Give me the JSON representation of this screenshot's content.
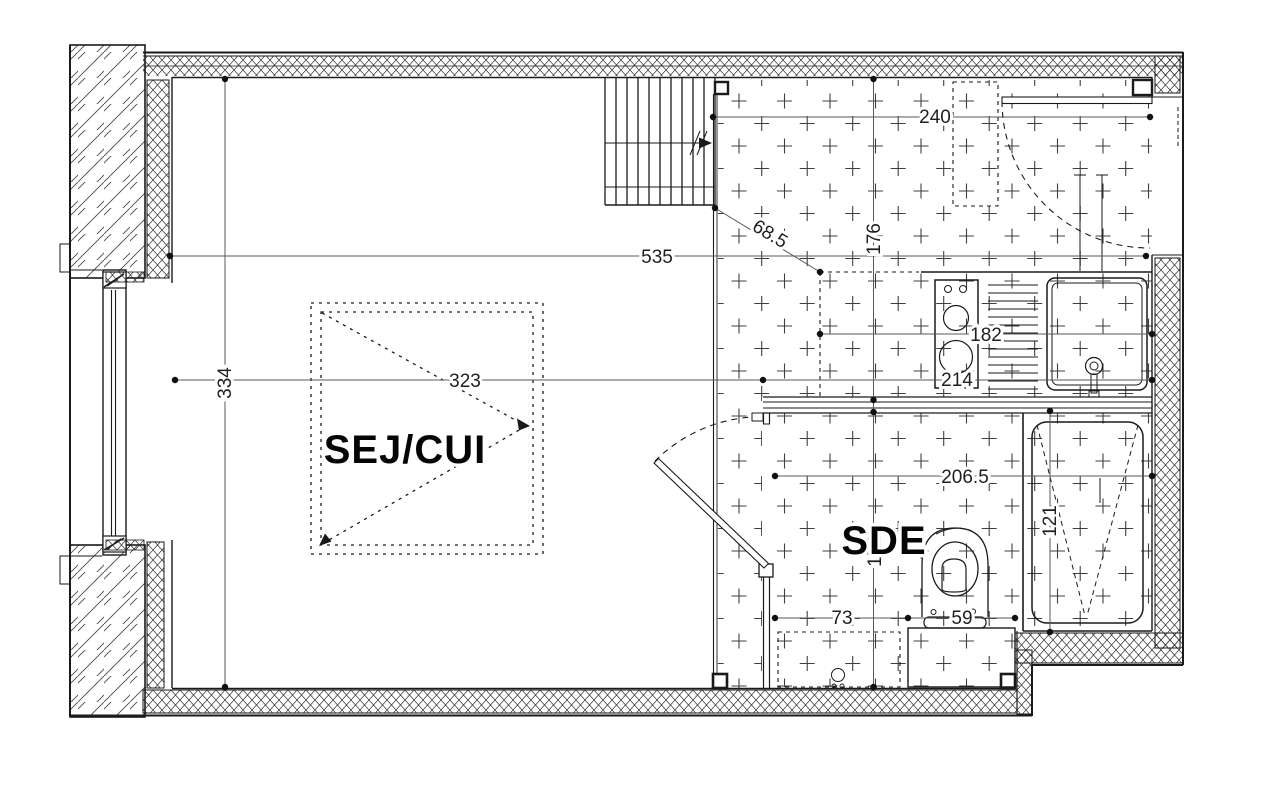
{
  "drawing_type": "apartment floor plan",
  "rooms": {
    "living_kitchen_label": "SEJ/CUI",
    "bathroom_label": "SDE"
  },
  "dimensions": {
    "entry_zone_width": "240",
    "overall_interior_width": "535",
    "kitchen_zone_depth": "176",
    "counter_diagonal": "68.5",
    "counter_run": "182",
    "kitchen_right_width": "214",
    "living_width": "323",
    "living_depth": "334",
    "bathroom_width": "206.5",
    "bathroom_depth": "152",
    "shower_length": "121",
    "wc_offset": "73",
    "wc_width": "59"
  },
  "colors": {
    "line": "#1a1a1a",
    "dim_line": "#5a5a5a",
    "tile_mark": "#3f3f3f",
    "text": "#1f1f1f"
  }
}
